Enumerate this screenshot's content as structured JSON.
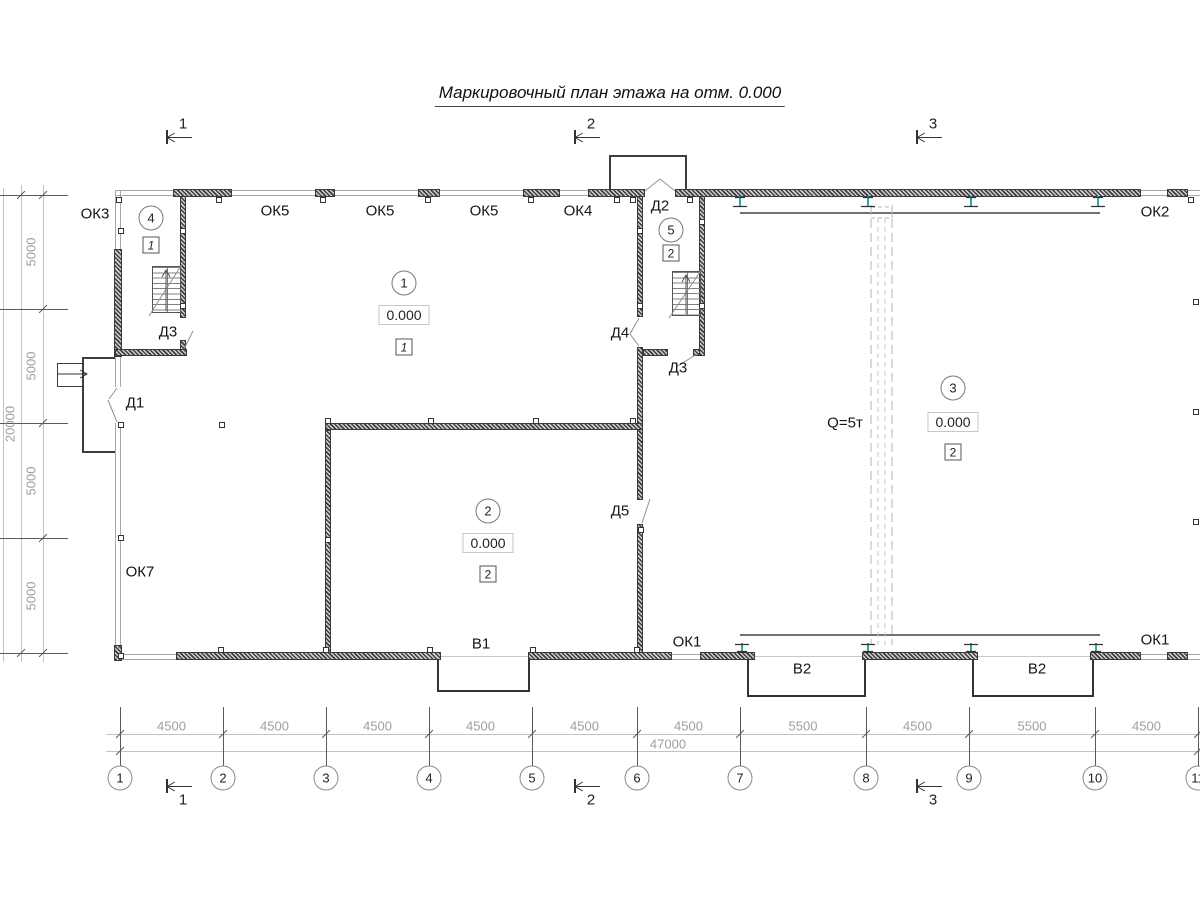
{
  "title": "Маркировочный план этажа на отм. 0.000",
  "crane": {
    "capacity_label": "Q=5т"
  },
  "labels": [
    {
      "text": "ОК3",
      "x": 95,
      "y": 214
    },
    {
      "text": "ОК5",
      "x": 275,
      "y": 211
    },
    {
      "text": "ОК5",
      "x": 380,
      "y": 211
    },
    {
      "text": "ОК5",
      "x": 484,
      "y": 211
    },
    {
      "text": "ОК4",
      "x": 578,
      "y": 211
    },
    {
      "text": "Д2",
      "x": 660,
      "y": 206
    },
    {
      "text": "ОК2",
      "x": 1155,
      "y": 212
    },
    {
      "text": "Д3",
      "x": 168,
      "y": 332
    },
    {
      "text": "Д4",
      "x": 620,
      "y": 333
    },
    {
      "text": "Д3",
      "x": 678,
      "y": 368
    },
    {
      "text": "Д1",
      "x": 135,
      "y": 403
    },
    {
      "text": "Д5",
      "x": 620,
      "y": 511
    },
    {
      "text": "ОК7",
      "x": 140,
      "y": 572
    },
    {
      "text": "В1",
      "x": 481,
      "y": 644
    },
    {
      "text": "ОК1",
      "x": 687,
      "y": 642
    },
    {
      "text": "В2",
      "x": 802,
      "y": 669
    },
    {
      "text": "В2",
      "x": 1037,
      "y": 669
    },
    {
      "text": "ОК1",
      "x": 1155,
      "y": 640
    },
    {
      "text": "Q=5т",
      "x": 845,
      "y": 423
    }
  ],
  "rooms": [
    {
      "num": "4",
      "x": 151,
      "y": 218,
      "floor": "1",
      "floor_y": 245,
      "italic": true
    },
    {
      "num": "1",
      "x": 404,
      "y": 283,
      "elevation": "0.000",
      "elev_y": 315,
      "floor": "1",
      "floor_y": 347,
      "italic": true
    },
    {
      "num": "5",
      "x": 671,
      "y": 230,
      "floor": "2",
      "floor_y": 253
    },
    {
      "num": "2",
      "x": 488,
      "y": 511,
      "elevation": "0.000",
      "elev_y": 543,
      "floor": "2",
      "floor_y": 574
    },
    {
      "num": "3",
      "x": 953,
      "y": 388,
      "elevation": "0.000",
      "elev_y": 422,
      "floor": "2",
      "floor_y": 452
    }
  ],
  "axes_bottom": {
    "px": [
      120,
      223,
      326,
      429,
      532,
      637,
      740,
      866,
      969,
      1095,
      1198
    ],
    "labels": [
      "1",
      "2",
      "3",
      "4",
      "5",
      "6",
      "7",
      "8",
      "9",
      "10",
      "11"
    ],
    "dims": [
      "4500",
      "4500",
      "4500",
      "4500",
      "4500",
      "4500",
      "5500",
      "4500",
      "5500",
      "4500"
    ],
    "total": "47000",
    "total_x": 668
  },
  "axes_left": {
    "py": [
      195,
      309,
      423,
      538,
      653
    ],
    "dims": [
      "5000",
      "5000",
      "5000",
      "5000"
    ],
    "total": "20000"
  },
  "sections": {
    "top_y": 137,
    "bottom_y": 786,
    "items": [
      {
        "num": "1",
        "x": 166
      },
      {
        "num": "2",
        "x": 574
      },
      {
        "num": "3",
        "x": 916
      }
    ]
  },
  "columns": [
    [
      119,
      200
    ],
    [
      219,
      200
    ],
    [
      323,
      200
    ],
    [
      428,
      200
    ],
    [
      531,
      200
    ],
    [
      617,
      200
    ],
    [
      633,
      200
    ],
    [
      690,
      200
    ],
    [
      1191,
      200
    ],
    [
      121,
      231
    ],
    [
      121,
      425
    ],
    [
      121,
      538
    ],
    [
      121,
      656
    ],
    [
      183,
      231
    ],
    [
      183,
      306
    ],
    [
      640,
      231
    ],
    [
      640,
      306
    ],
    [
      702,
      222
    ],
    [
      702,
      306
    ],
    [
      1196,
      302
    ],
    [
      1196,
      412
    ],
    [
      1196,
      522
    ],
    [
      328,
      421
    ],
    [
      431,
      421
    ],
    [
      536,
      421
    ],
    [
      633,
      421
    ],
    [
      328,
      540
    ],
    [
      641,
      530
    ],
    [
      222,
      425
    ],
    [
      221,
      650
    ],
    [
      326,
      650
    ],
    [
      430,
      650
    ],
    [
      533,
      650
    ],
    [
      637,
      650
    ]
  ]
}
